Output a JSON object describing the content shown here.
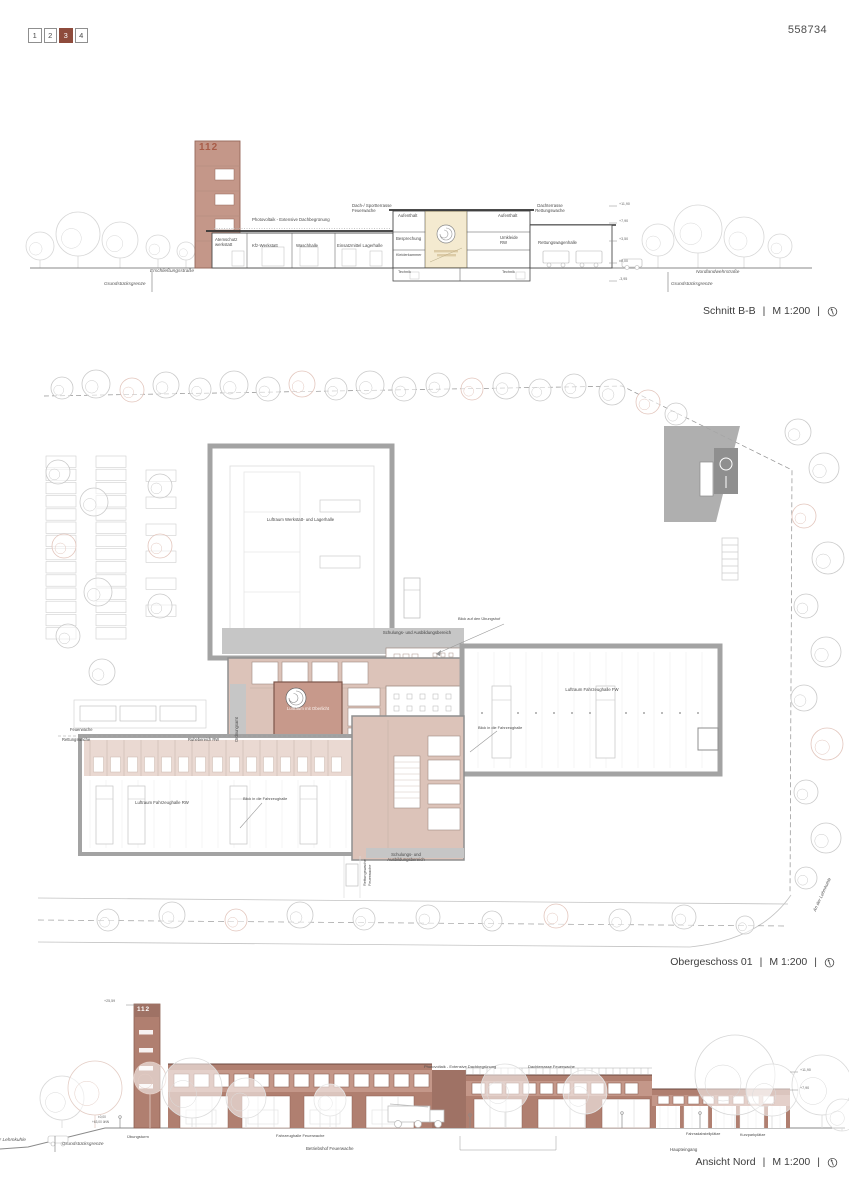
{
  "ui": {
    "sep": "|"
  },
  "header": {
    "pages": [
      {
        "label": "1",
        "active": false
      },
      {
        "label": "2",
        "active": false
      },
      {
        "label": "3",
        "active": true
      },
      {
        "label": "4",
        "active": false
      }
    ],
    "sheet_number": "558734"
  },
  "section": {
    "title": "Schnitt B-B",
    "scale": "M 1:200",
    "tower_number": "112",
    "labels": {
      "photovoltaik": "Photovoltaik - Extensive Dachbegrünung",
      "dach_sportterrasse": "Dach-/ Sportterrasse Feuerwache",
      "dachterrasse_rettungswache": "Dachterrasse Rettungswache",
      "aufenthalt_links": "Aufenthalt",
      "besprechung": "Besprechung",
      "kleiderkammer": "Kleiderkammer",
      "aufenthalt_rechts": "Aufenthalt",
      "umkleide": "Umkleide RW",
      "rettungswagenhalle": "Rettungswagenhalle",
      "atemschutzwerkstatt": "Atemschutz werkstatt",
      "kfz_werkstatt": "Kfz-Werkstatt",
      "waschhalle": "Waschhalle",
      "einsatzmittel": "Einsatzmittel Lagerhalle",
      "technik_1": "Technik",
      "technik_2": "Technik"
    },
    "levels": [
      "+11,90",
      "+7,90",
      "+3,50",
      "±0,00",
      "-3,95"
    ],
    "streets": {
      "left": "Erschließungsstraße",
      "left_boundary": "Grundstücksgrenze",
      "right": "Nordlandwehrstraße",
      "right_boundary": "Grundstücksgrenze"
    }
  },
  "plan": {
    "title": "Obergeschoss 01",
    "scale": "M 1:200",
    "labels": {
      "luftraum_werkstatt": "Luftraum Werkstatt- und Lagerhalle",
      "schulung_oben": "Schulungs- und Ausbildungsbereich",
      "blick_uebungshof": "Blick auf den Übungshof",
      "luftraum_fw": "Luftraum Fahrzeughalle FW",
      "luftraum_oberlicht": "Luftraum mit Oberlicht",
      "ordnungsamt": "Ordnungsamt",
      "feuerwache": "Feuerwache",
      "rettungswache": "Rettungswache",
      "ruhebereich": "Ruhebereich RW",
      "luftraum_rw": "Luftraum Fahrzeughalle RW",
      "blick_fahrzeughalle_1": "Blick in die Fahrzeughalle",
      "blick_fahrzeughalle_2": "Blick in die Fahrzeughalle",
      "rettungswache_vert": "Rettungswache",
      "feuerwache_vert": "Feuerwache",
      "schulung_unten": "Schulungs- und Ausbildungsbereich",
      "strasse_rechts": "An der Lehmkuhle"
    }
  },
  "elevation": {
    "title": "Ansicht Nord",
    "scale": "M 1:200",
    "tower_number": "112",
    "labels": {
      "photovoltaik": "Photovoltaik - Extensive Dachbegrünung",
      "dachterrasse": "Dachterrasse Feuerwache",
      "strasse": "An der Lehmkuhle",
      "grenze": "Grundstücksgrenze",
      "uebungsturm": "Übungsturm",
      "fahrzeughalle": "Fahrzeughalle Feuerwache",
      "betriebshof": "Betriebshof Feuerwache",
      "fahrrad": "Fahrradabstellplätze",
      "kurzpark": "Kurzparkplätze",
      "haupteingang": "Haupteingang"
    },
    "levels": {
      "tower": "+25,59",
      "upper": "+11,90",
      "mid": "+7,90",
      "zero": "±0,00",
      "unn": "+63,00 üNN"
    }
  },
  "colors": {
    "page_active": "#8e4b3c",
    "brick": "#c49789",
    "brick_dark": "#b07f70",
    "plan_pink": "#dcc3b9",
    "plan_salmon": "#c7998b",
    "wall_gray": "#a3a3a3",
    "band_gray": "#c6c6c6",
    "stair_yellow": "#f4ead0"
  }
}
